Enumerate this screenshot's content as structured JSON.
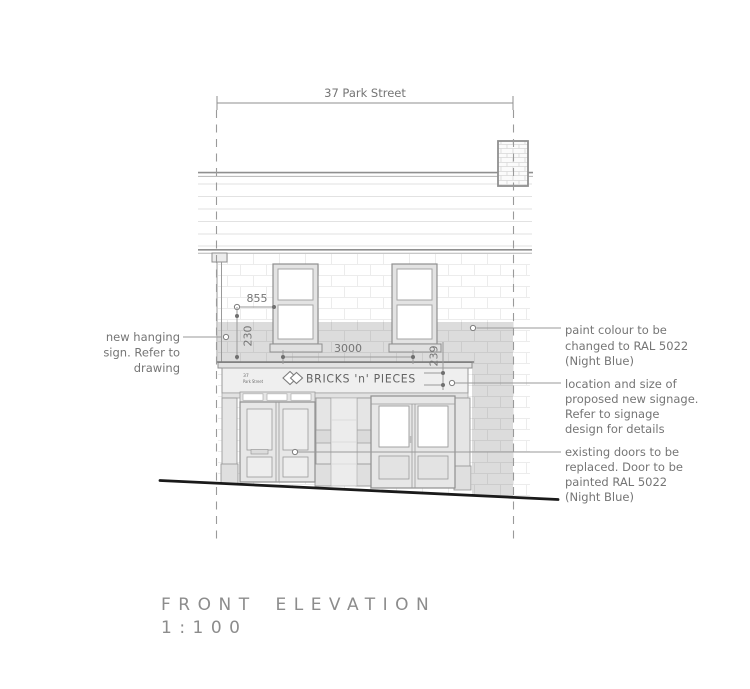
{
  "drawing": {
    "header_dimension": {
      "label": "37 Park Street"
    },
    "dimensions": {
      "sign_offset": "855",
      "sign_drop": "230",
      "signage_width": "3000",
      "fascia_height": "239"
    },
    "fascia": {
      "plaque_number": "37",
      "plaque_street": "Park Street",
      "shop_sign": "BRICKS 'n' PIECES",
      "logo": "double-diamond-icon"
    },
    "annotations": {
      "hanging_sign": {
        "lines": [
          "new hanging",
          "sign. Refer to",
          "drawing"
        ]
      },
      "paint": {
        "lines": [
          "paint colour to be",
          "changed to RAL 5022",
          "(Night Blue)"
        ]
      },
      "signage": {
        "lines": [
          "location and size of",
          "proposed new signage.",
          "Refer to signage",
          "design for details"
        ]
      },
      "doors": {
        "lines": [
          "existing doors to be",
          "replaced. Door to be",
          "painted RAL 5022",
          "(Night Blue)"
        ]
      }
    },
    "title_block": {
      "title": "FRONT ELEVATION",
      "scale": "1:100"
    },
    "colors": {
      "line_grey": "#8f8f8f",
      "text_grey": "#757575",
      "paint_band": "#dcdcdc",
      "ground_line": "#1a1a1a",
      "faint_brick": "#eaeaea",
      "glass": "#ffffff"
    }
  }
}
